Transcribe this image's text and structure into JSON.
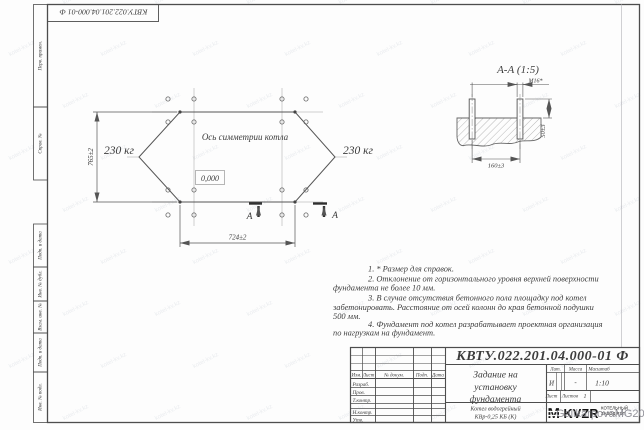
{
  "frame": {
    "doc_number_top": "КВТУ.022.201.04.000-01 Ф",
    "side_labels": [
      "Перв. примен.",
      "Справ. №",
      "Подп. и дата",
      "Инв. № дубл.",
      "Взам. инв. №",
      "Подп. и дата",
      "Инв. № подл."
    ]
  },
  "plan": {
    "symmetry_axis_label": "Ось симметрии котла",
    "level_mark": "0,000",
    "load_left": "230 кг",
    "load_right": "230 кг",
    "dim_height": "765±2",
    "dim_width": "724±2",
    "section_letter_left": "А",
    "section_letter_right": "А"
  },
  "section_view": {
    "title": "А-А (1:5)",
    "bolt_thread": "М16*",
    "dim_protrusion": "50±3",
    "dim_bolt_spacing": "160±3"
  },
  "notes": {
    "lines": [
      "1. * Размер для справок.",
      "2. Отклонение от горизонтального уровня верхней поверхности",
      "фундамента не более 10 мм.",
      "3. В случае отсутствия бетонного пола площадку под котел",
      "забетонировать. Расстояние от осей колонн до края бетонной подушки",
      "500 мм.",
      "4. Фундамент под котел разрабатывает проектная организация",
      "по нагрузкам на фундамент."
    ]
  },
  "title_block": {
    "doc_number": "КВТУ.022.201.04.000-01 Ф",
    "title_lines": [
      "Задание на",
      "установку",
      "фундамента"
    ],
    "product_lines": [
      "Котел водогрейный",
      "КВр-0,25 КБ (К)"
    ],
    "change_header": {
      "izm": "Изм.",
      "list": "Лист",
      "doc": "№ докум.",
      "podp": "Подп.",
      "data": "Дата"
    },
    "sig_rows": [
      "Разраб.",
      "Пров.",
      "Т.контр.",
      "Н.контр.",
      "Утв."
    ],
    "lit_label": "Лит.",
    "mass_label": "Масса",
    "scale_label": "Масштаб",
    "lit_value": "И",
    "mass_value": "-",
    "scale_value": "1:10",
    "sheet_label": "Лист",
    "sheets_label": "Листов",
    "sheets_value": "1",
    "logo": {
      "mark": "M",
      "name": "KVZR",
      "sub_lines": [
        "КОТЕЛЬНЫЙ",
        "ЗАВОД РЭП"
      ]
    }
  },
  "watermark": {
    "signature": "GalikarpovaMG2021",
    "tile_text": "kotel-kv.kz"
  },
  "colors": {
    "line": "#4d4d4d",
    "thin": "#999999",
    "text": "#3c3c3c",
    "watermark": "#808089"
  }
}
